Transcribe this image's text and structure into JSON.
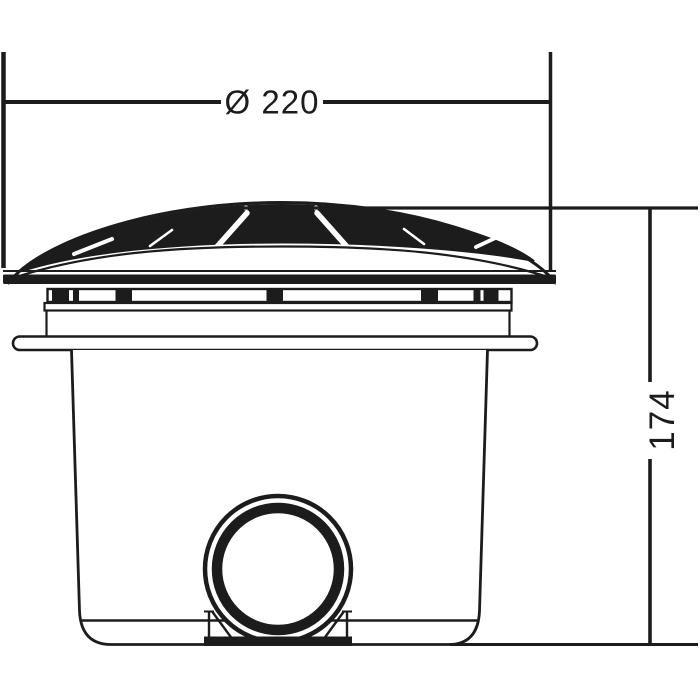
{
  "page": {
    "background_color": "#ffffff"
  },
  "drawing": {
    "line_color": "#1c1c1c",
    "dimensions": {
      "diameter_label": "Ø 220",
      "height_label": "174"
    }
  }
}
